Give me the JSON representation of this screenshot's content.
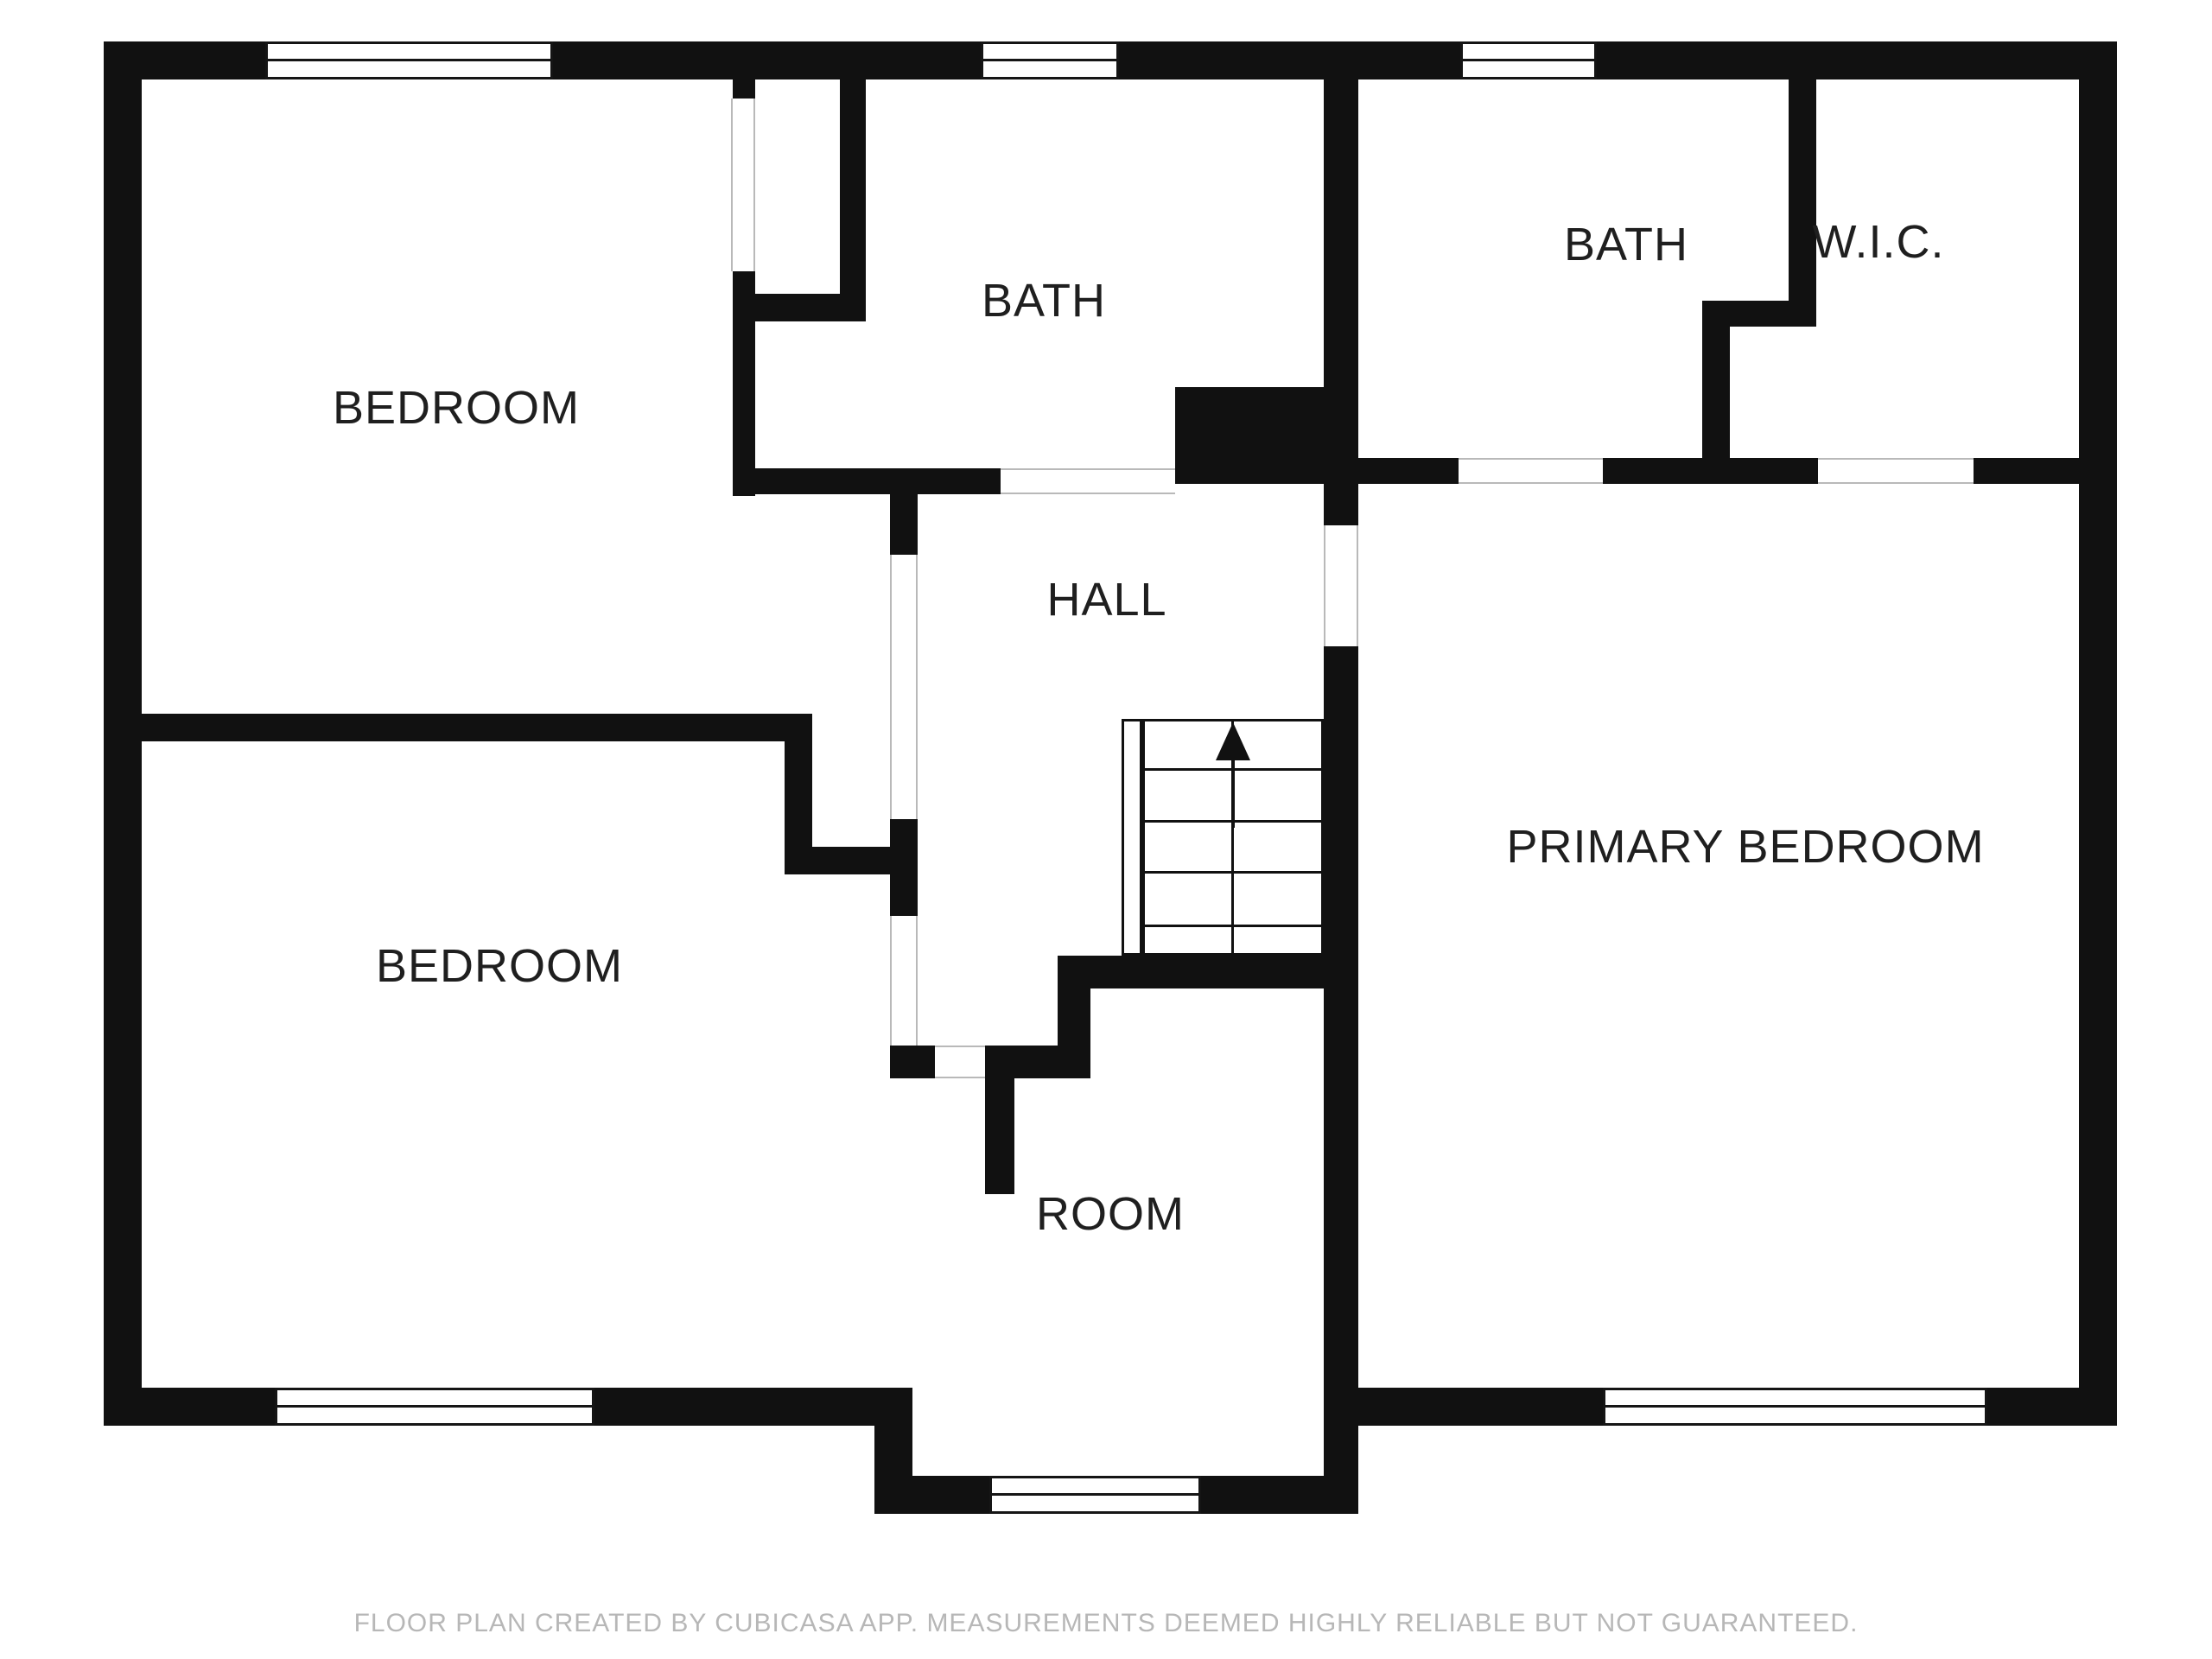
{
  "rooms": {
    "bedroom_top_left": {
      "label": "BEDROOM"
    },
    "bath_top_middle": {
      "label": "BATH"
    },
    "bath_top_right": {
      "label": "BATH"
    },
    "wic": {
      "label": "W.I.C."
    },
    "hall": {
      "label": "HALL"
    },
    "bedroom_bottom_left": {
      "label": "BEDROOM"
    },
    "primary_bedroom": {
      "label": "PRIMARY BEDROOM"
    },
    "room": {
      "label": "ROOM"
    }
  },
  "stairs": {
    "direction": "up"
  },
  "footer": {
    "disclaimer": "FLOOR PLAN CREATED BY CUBICASA APP. MEASUREMENTS DEEMED HIGHLY RELIABLE BUT NOT GUARANTEED."
  },
  "colors": {
    "background": "#ffffff",
    "wall": "#111111",
    "label_text": "#1f1f1f",
    "door_line": "#b9b9b9",
    "footer_text": "#b7b7b7"
  }
}
